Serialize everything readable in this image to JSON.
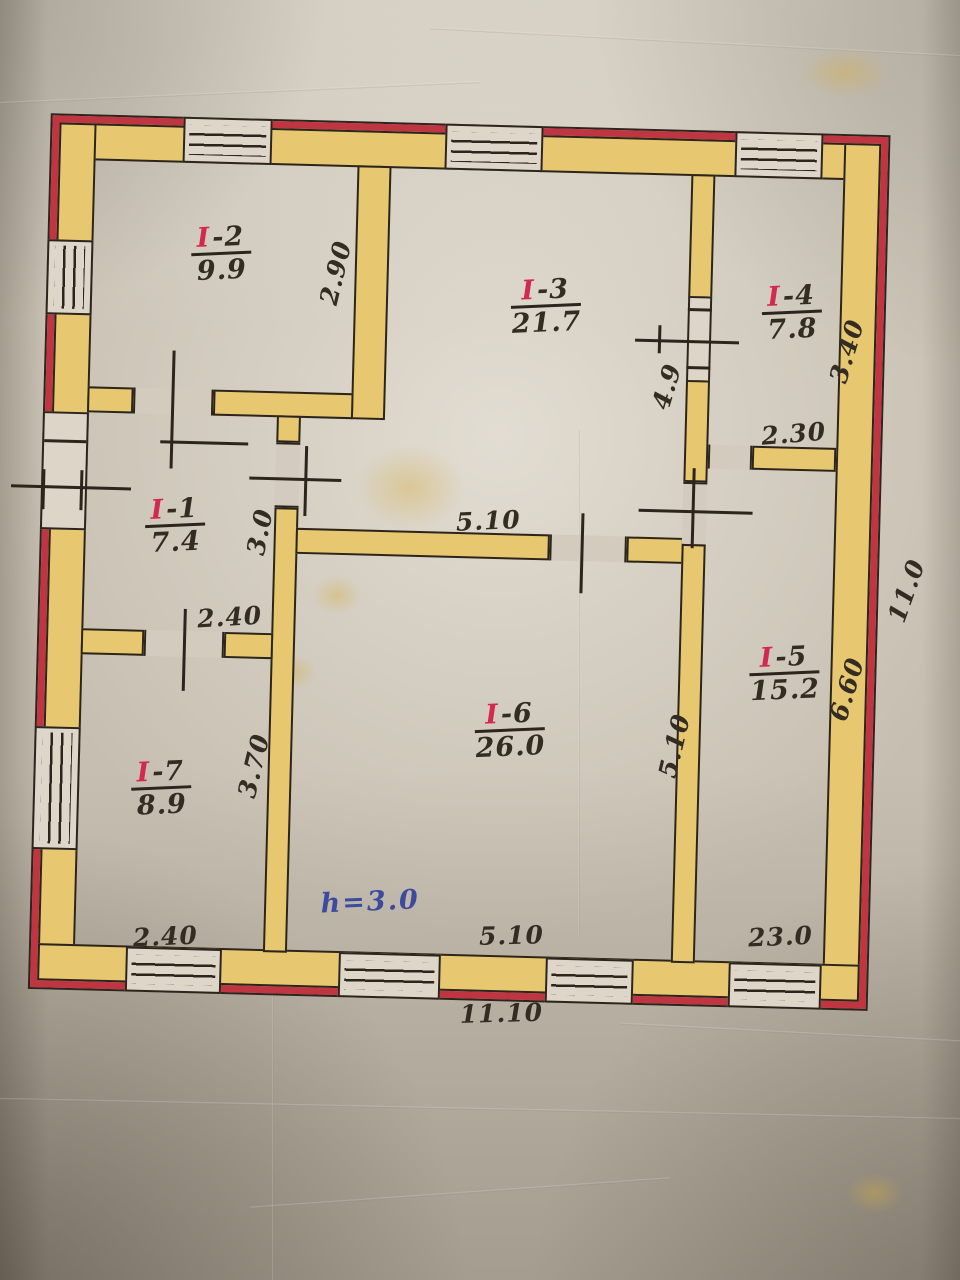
{
  "plan": {
    "note_height": "h=3.0",
    "rooms": [
      {
        "prefix": "I",
        "num": "-1",
        "area": "7.4"
      },
      {
        "prefix": "I",
        "num": "-2",
        "area": "9.9"
      },
      {
        "prefix": "I",
        "num": "-3",
        "area": "21.7"
      },
      {
        "prefix": "I",
        "num": "-4",
        "area": "7.8"
      },
      {
        "prefix": "I",
        "num": "-5",
        "area": "15.2"
      },
      {
        "prefix": "I",
        "num": "-6",
        "area": "26.0"
      },
      {
        "prefix": "I",
        "num": "-7",
        "area": "8.9"
      }
    ],
    "dims": {
      "i2_width": "2.90",
      "i3_i4_opening": "4.9",
      "i4_depth": "3.40",
      "i4_width": "2.30",
      "i1_depth": "3.0",
      "i1_width": "2.40",
      "i6_top_width": "5.10",
      "i6_right_depth": "5.10",
      "i5_depth": "6.60",
      "house_depth": "11.0",
      "i7_depth": "3.70",
      "i7_width": "2.40",
      "i6_bottom_width": "5.10",
      "i5_bottom_width": "23.0",
      "house_width": "11.10"
    },
    "colors": {
      "wall_fill": "#e7c76f",
      "wall_edge_red": "#bf3541",
      "ink": "#2c251d",
      "room_accent": "#d2294f",
      "note_ink": "#3d4b9f"
    }
  }
}
